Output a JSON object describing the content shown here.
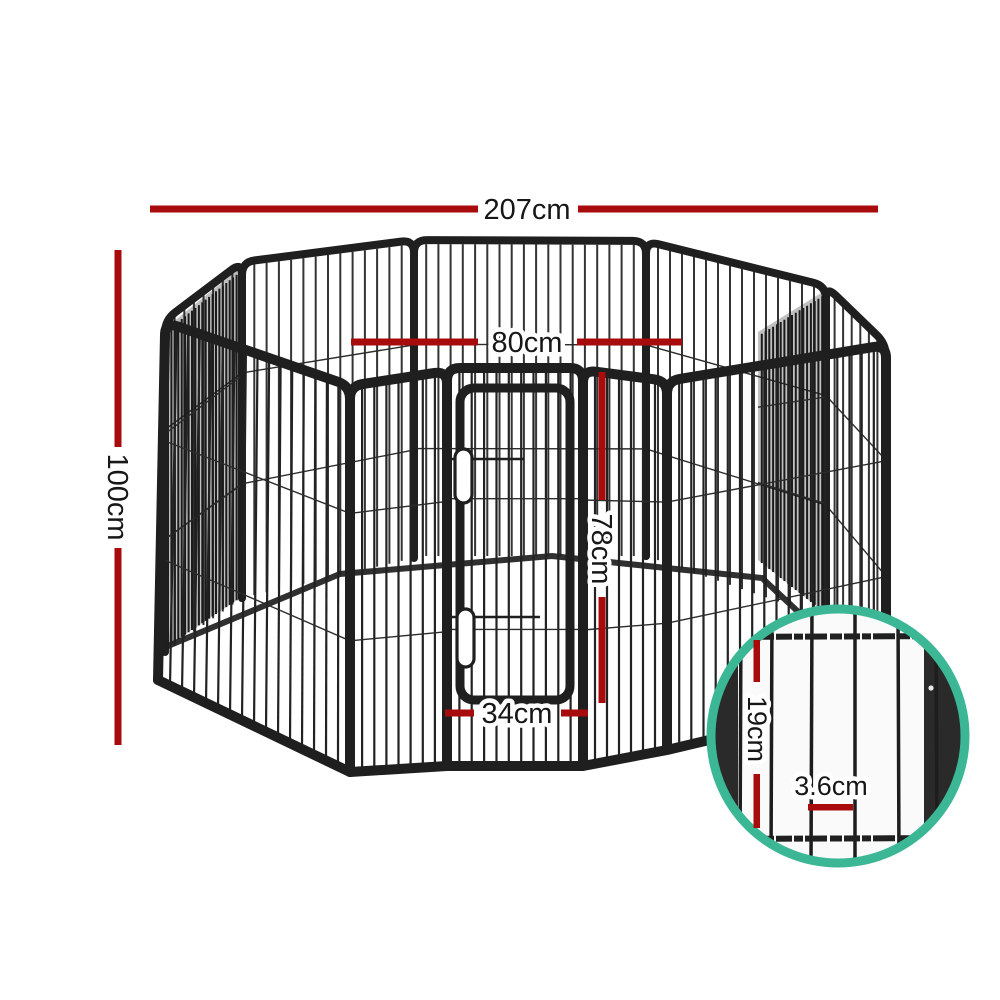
{
  "diagram": {
    "type": "product-dimension-diagram",
    "subject": "8-panel metal pet playpen with hinged door and magnified wire detail",
    "background": "#ffffff"
  },
  "dims": {
    "total_width": "207cm",
    "total_height": "100cm",
    "panel_width": "80cm",
    "door_height": "78cm",
    "door_width": "34cm",
    "detail_rail_spacing": "19cm",
    "detail_wire_gap": "3.6cm"
  },
  "colors": {
    "dimension_line": "#a80b0b",
    "label_text": "#171717",
    "detail_circle_ring": "#3bb795",
    "frame_metal": "#1f1f1f"
  }
}
